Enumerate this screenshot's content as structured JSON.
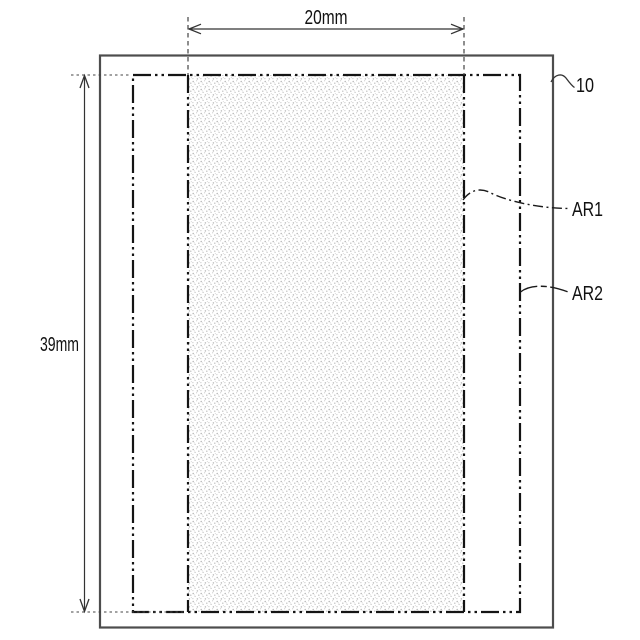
{
  "dimensions": {
    "width_label": "20mm",
    "height_label": "39mm"
  },
  "labels": {
    "substrate": "10",
    "area1": "AR1",
    "area2": "AR2"
  },
  "colors": {
    "background": "#ffffff",
    "outer_outline": "#4d4d4d",
    "chain_line": "#141414",
    "dimension_line": "#333333",
    "stipple_dot": "#bdbdbd",
    "stipple_background": "#ffffff"
  }
}
